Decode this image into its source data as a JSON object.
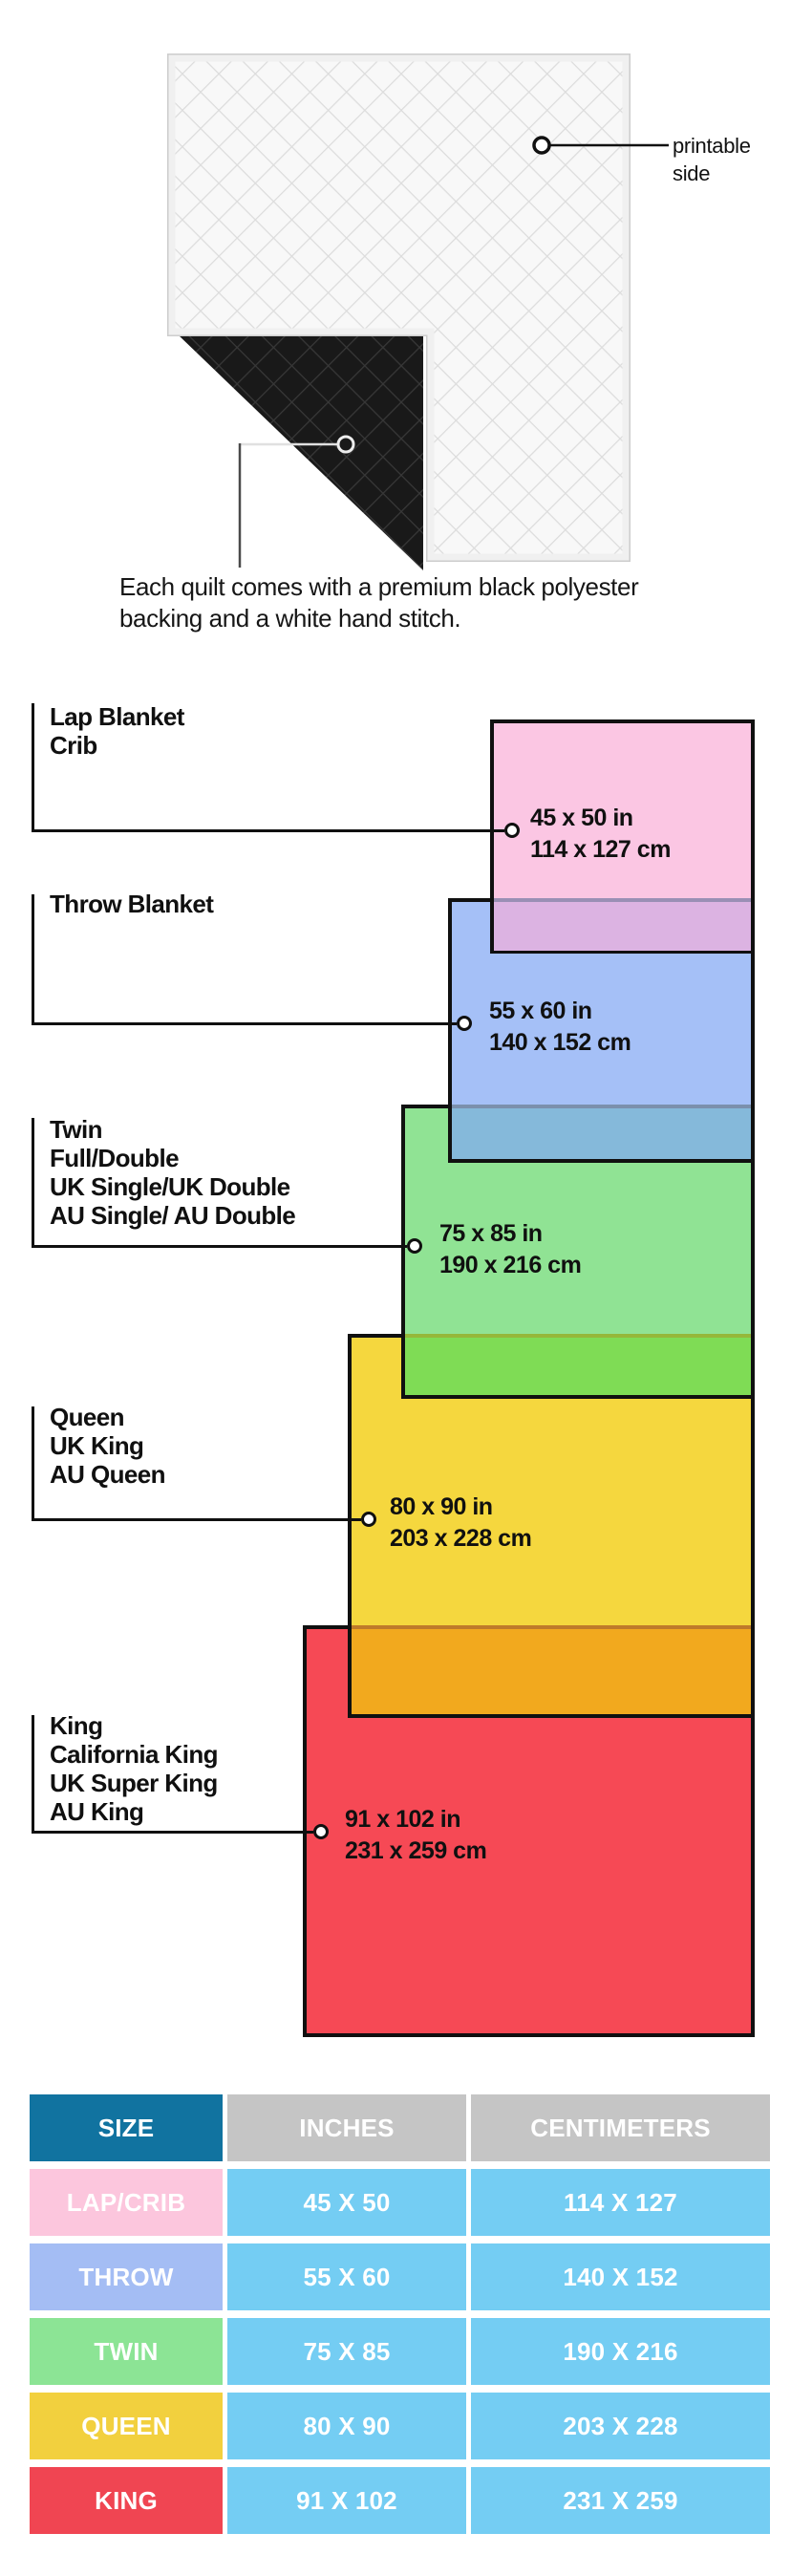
{
  "quilt": {
    "printable_label_lines": [
      "printable",
      "side"
    ],
    "caption_lines": [
      "Each quilt comes with a premium black polyester",
      "backing and a white hand stitch."
    ]
  },
  "diagram": {
    "items": [
      {
        "id": "lap-crib",
        "labels": [
          "Lap Blanket",
          "Crib"
        ],
        "inches": "45 x 50 in",
        "cm": "114 x 127 cm",
        "fill": "#fbc6e3",
        "overlap_fill": "#dcb3e2"
      },
      {
        "id": "throw",
        "labels": [
          "Throw Blanket"
        ],
        "inches": "55 x 60 in",
        "cm": "140 x 152 cm",
        "fill": "#a5c0f7",
        "overlap_fill": "#85b9da"
      },
      {
        "id": "twin",
        "labels": [
          "Twin",
          "Full/Double",
          "UK Single/UK Double",
          "AU Single/ AU Double"
        ],
        "inches": "75 x 85 in",
        "cm": "190 x 216 cm",
        "fill": "#90e394",
        "overlap_fill": "#7fdc55"
      },
      {
        "id": "queen",
        "labels": [
          "Queen",
          "UK King",
          "AU Queen"
        ],
        "inches": "80 x 90 in",
        "cm": "203 x 228 cm",
        "fill": "#f5d73e",
        "overlap_fill": "#f2a91e"
      },
      {
        "id": "king",
        "labels": [
          "King",
          "California King",
          "UK Super King",
          "AU King"
        ],
        "inches": "91 x 102 in",
        "cm": "231 x 259 cm",
        "fill": "#f64955",
        "overlap_fill": ""
      }
    ]
  },
  "table": {
    "headers": [
      "SIZE",
      "INCHES",
      "CENTIMETERS"
    ],
    "header_colors": {
      "size": "#1173a0",
      "measure": "#c5c5c5"
    },
    "cell_color": "#74cdf3",
    "rows": [
      {
        "size": "LAP/CRIB",
        "inches": "45 X 50",
        "cm": "114 X 127",
        "color": "#fcc6dd"
      },
      {
        "size": "THROW",
        "inches": "55 X 60",
        "cm": "140 X 152",
        "color": "#a4bdf4"
      },
      {
        "size": "TWIN",
        "inches": "75 X 85",
        "cm": "190 X 216",
        "color": "#8ce495"
      },
      {
        "size": "QUEEN",
        "inches": "80 X 90",
        "cm": "203 X 228",
        "color": "#f2d03e"
      },
      {
        "size": "KING",
        "inches": "91 X 102",
        "cm": "231 X 259",
        "color": "#f04552"
      }
    ]
  }
}
